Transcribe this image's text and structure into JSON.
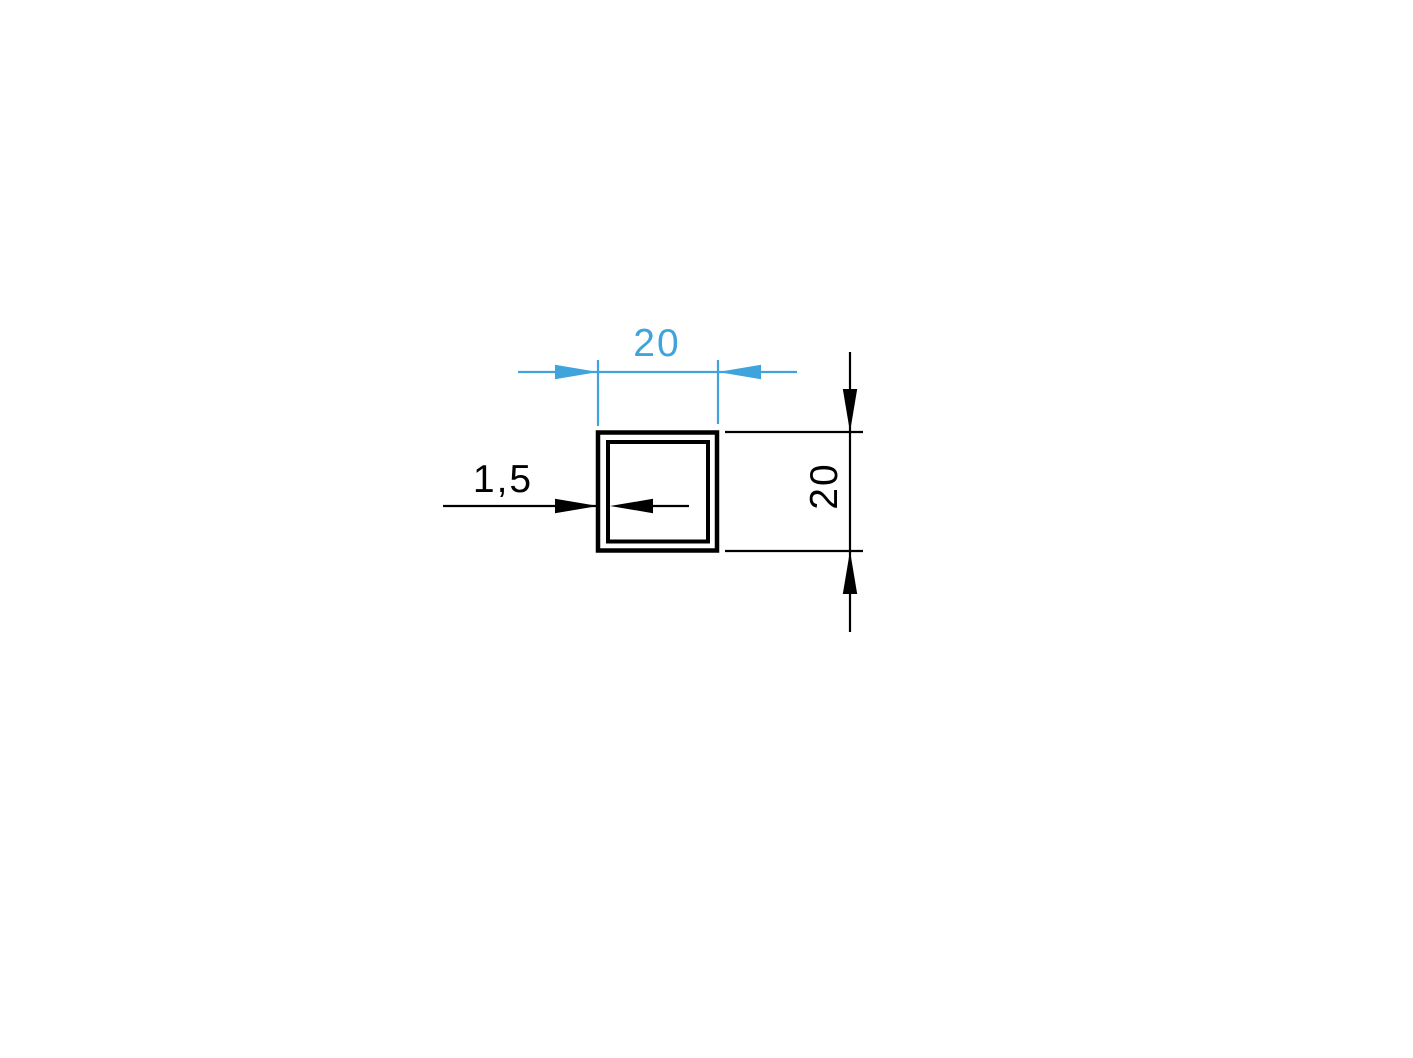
{
  "colors": {
    "accent_blue": "#3FA3DC",
    "line_black": "#000000",
    "background": "#FFFFFF"
  },
  "drawing": {
    "width_dimension": {
      "label": "20"
    },
    "height_dimension": {
      "label": "20"
    },
    "thickness_callout": {
      "label": "1,5"
    }
  }
}
